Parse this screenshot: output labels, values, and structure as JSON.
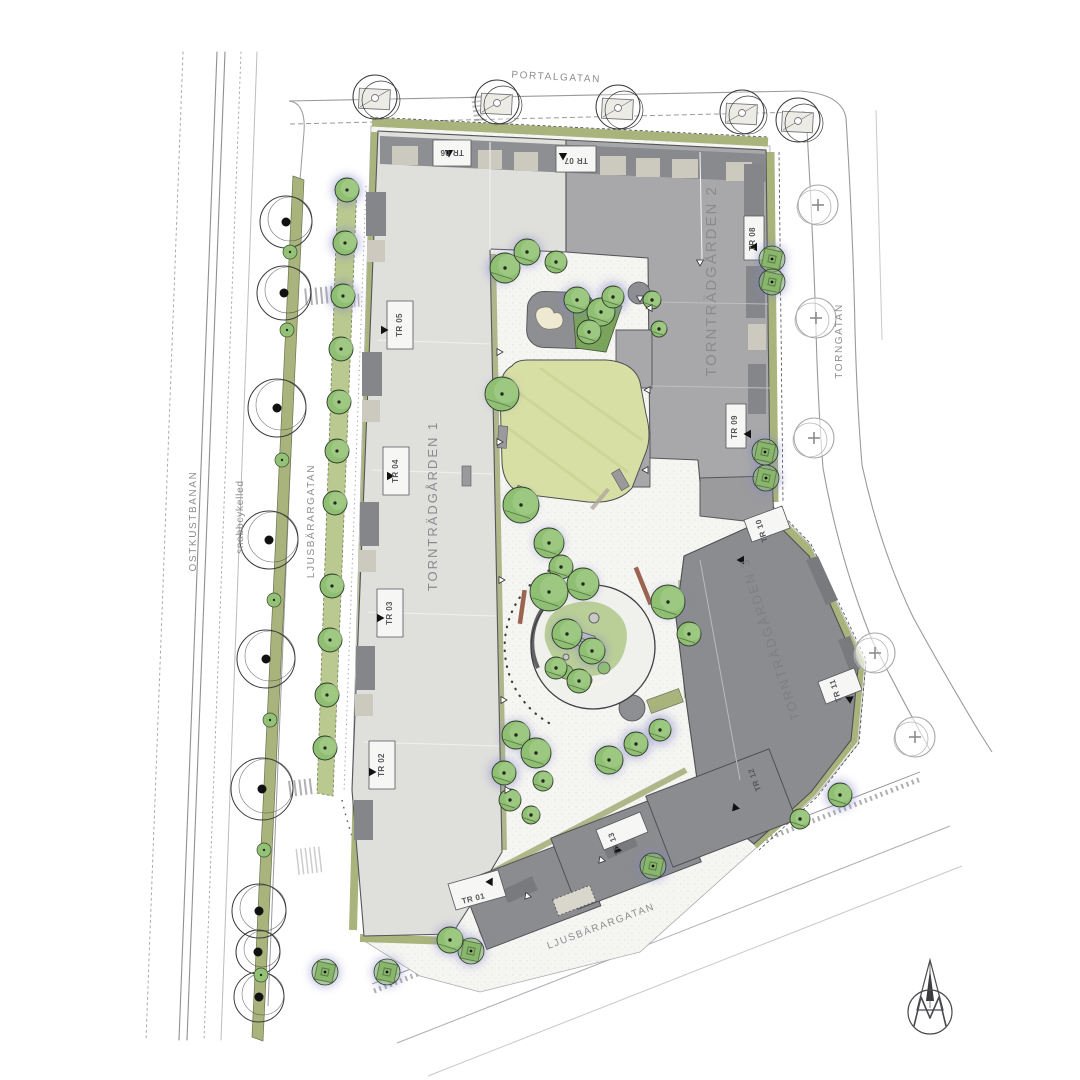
{
  "title": "Site plan – Tornträdgården",
  "streets": {
    "portalgatan": "PORTALGATAN",
    "torngatan": "TORNGATAN",
    "ostkustbanan": "OSTKUSTBANAN",
    "snabbcykelled": "snabbcykelled",
    "ljusbarargatan_west": "LJUSBÄRARGATAN",
    "ljusbarargatan_south": "LJUSBÄRARGATAN"
  },
  "buildings": {
    "b1": "TORNTRÄDGÅRDEN 1",
    "b2": "TORNTRÄDGÅRDEN 2",
    "b3": "TORNTRÄDGÅRDEN 3"
  },
  "stairs": {
    "tr01": "TR 01",
    "tr02": "TR 02",
    "tr03": "TR 03",
    "tr04": "TR 04",
    "tr05": "TR 05",
    "tr06": "TR 06",
    "tr07": "TR 07",
    "tr08": "TR 08",
    "tr09": "TR 09",
    "tr10": "TR 10",
    "tr11": "TR 11",
    "tr12": "TR 12",
    "tr13": "TR 13"
  },
  "icons": {
    "north_arrow_logo": "spire-with-m-north-arrow",
    "tree_planted": "green-canopy-tree",
    "tree_existing": "outline-tree-black-dot",
    "tree_street_plus": "street-tree-plus-mark",
    "tree_planter": "tree-in-square-planter"
  },
  "colors": {
    "building_light": "#dfdfdc",
    "building_mid": "#a8a8aa",
    "building_dark": "#8b8c8f",
    "roof_dark": "#85868a",
    "roof_beige": "#ccc9bf",
    "tree_green": "#8fbf72",
    "lawn": "#d8dfa4",
    "verge_olive": "#a9b37c",
    "median_green": "#b9c98f",
    "shadow_glow": "#8285c6",
    "linework": "#55565a",
    "label_gray": "#8d8d90"
  }
}
